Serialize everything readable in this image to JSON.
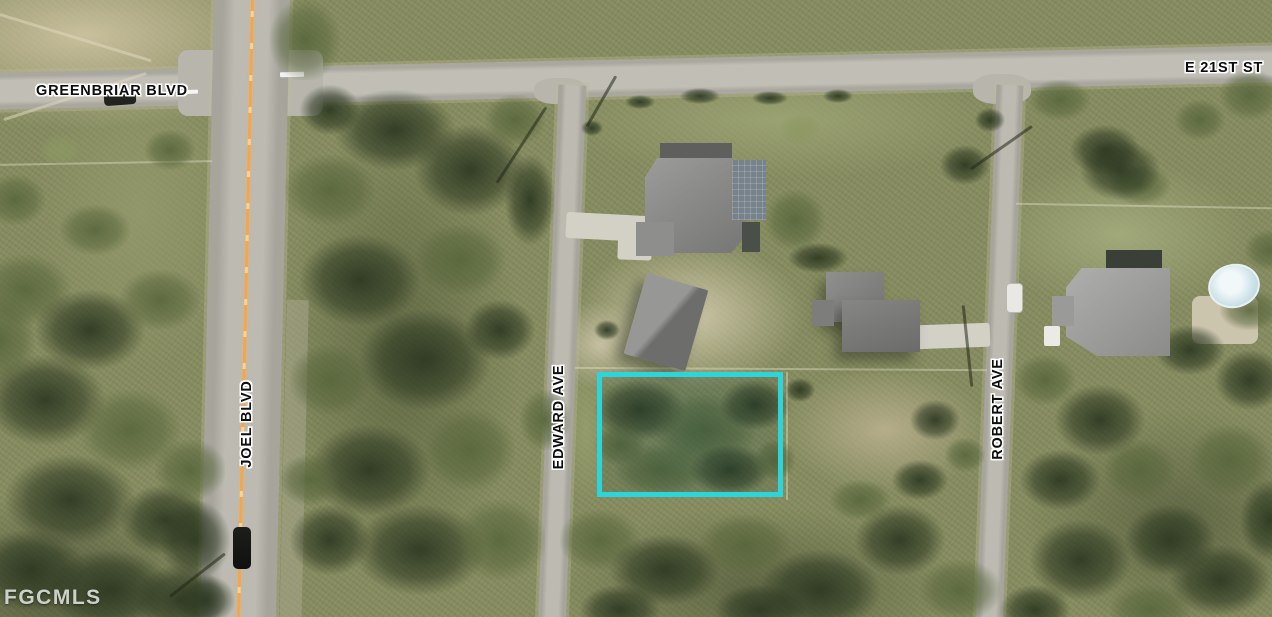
{
  "map": {
    "watermark": "FGCMLS",
    "street_labels": {
      "greenbriar": "GREENBRIAR BLVD",
      "e21st": "E 21ST ST",
      "joel": "JOEL BLVD",
      "edward": "EDWARD AVE",
      "robert": "ROBERT AVE"
    },
    "parcel_highlight": {
      "outline_color": "#2BD5DA"
    }
  }
}
